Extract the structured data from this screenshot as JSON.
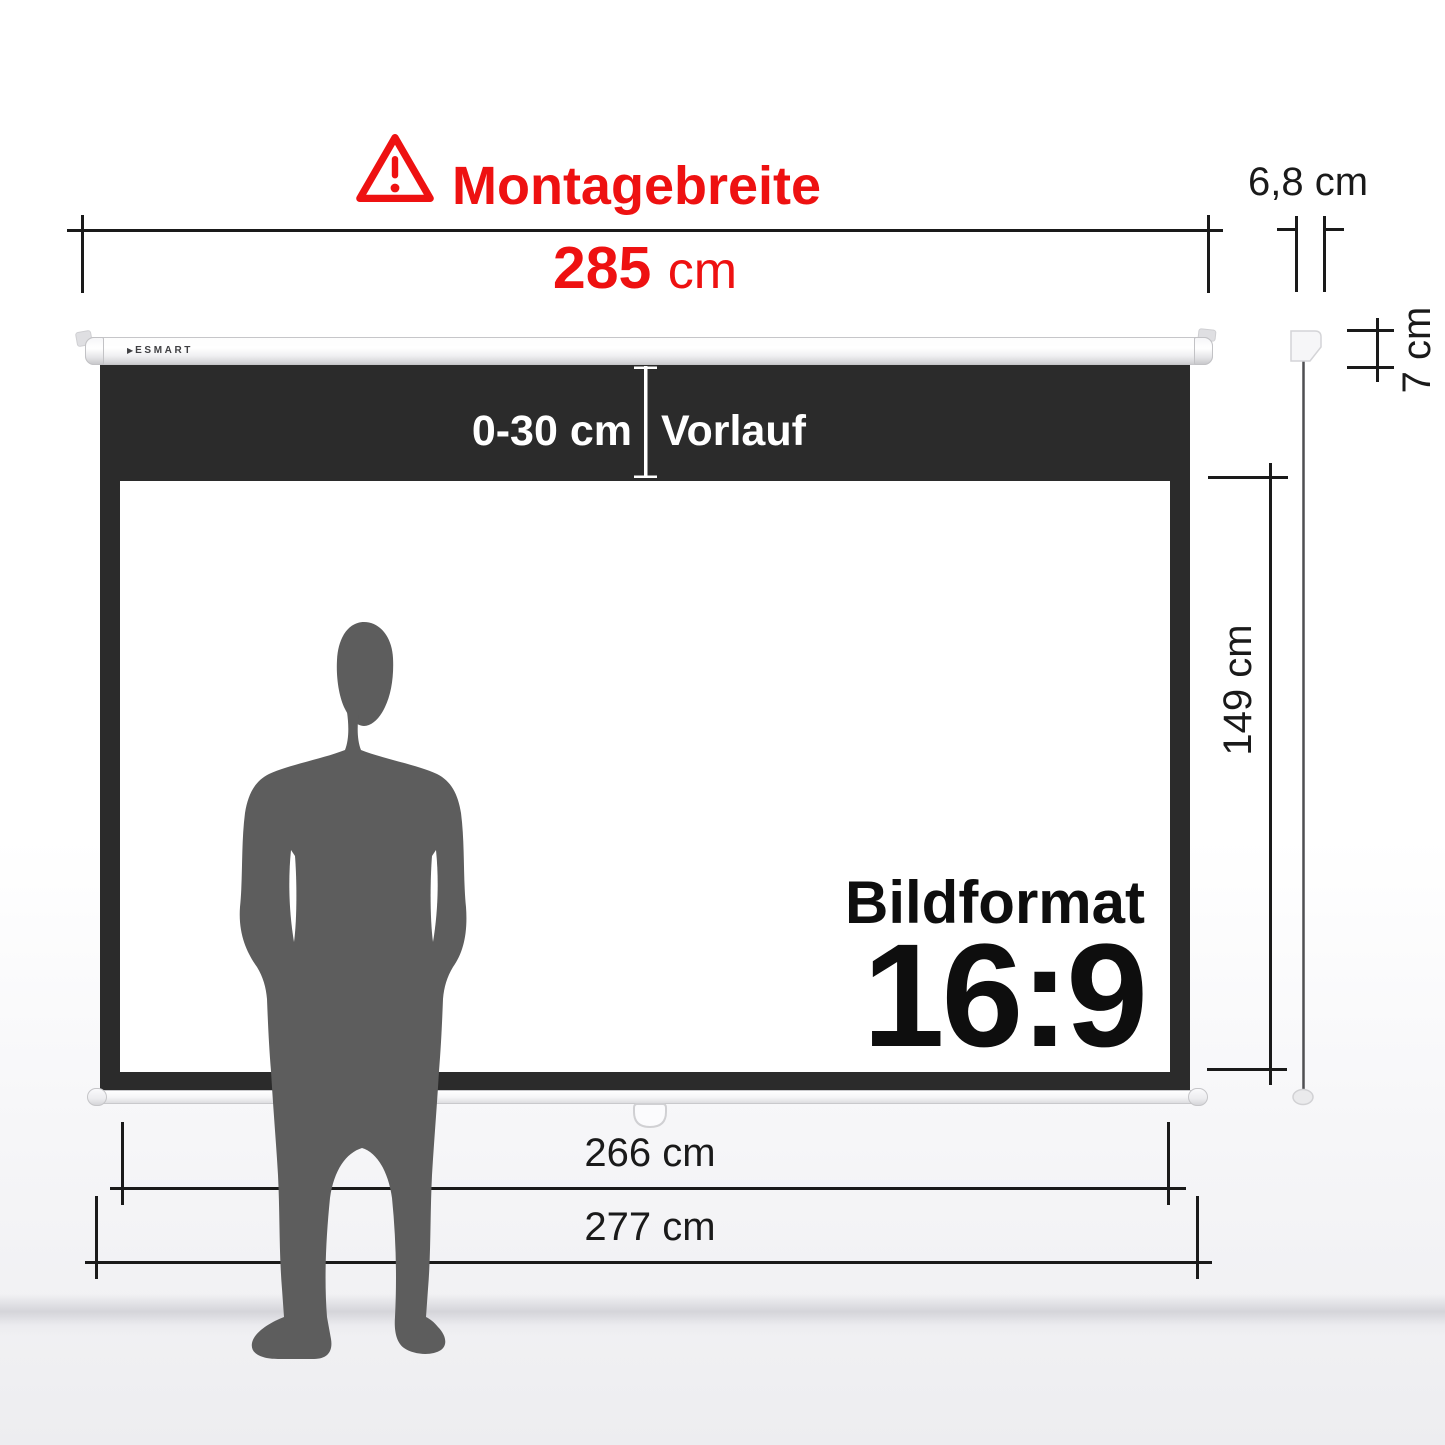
{
  "colors": {
    "accent_red": "#EE1111",
    "screen_frame": "#2B2B2B",
    "silhouette": "#5D5D5D",
    "dim_line": "#1A1A1A"
  },
  "header": {
    "warning_icon": "warning-triangle-icon",
    "title": "Montagebreite"
  },
  "dimensions": {
    "mount_width": {
      "value": "285",
      "unit": "cm"
    },
    "housing_depth": {
      "label": "6,8 cm"
    },
    "housing_height": {
      "label": "7 cm"
    },
    "vorlauf": {
      "range": "0-30 cm",
      "name": "Vorlauf"
    },
    "screen_height": {
      "label": "149 cm"
    },
    "viewing_width": {
      "label": "266 cm"
    },
    "total_width": {
      "label": "277 cm"
    }
  },
  "screen": {
    "brand": "ESMART",
    "brand_arrow": "▶",
    "aspect_title": "Bildformat",
    "aspect_ratio": "16:9"
  }
}
